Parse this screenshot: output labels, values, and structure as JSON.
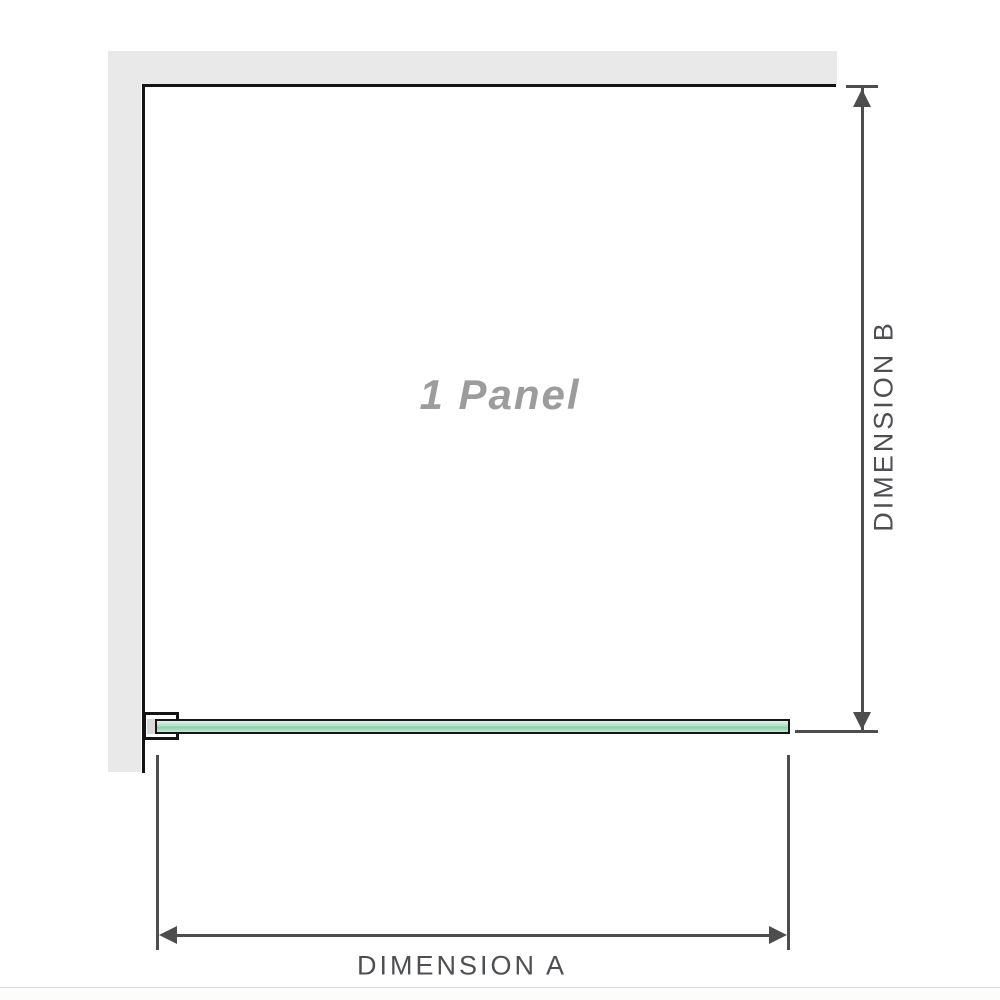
{
  "diagram": {
    "panel_label": "1 Panel",
    "dimension_a_label": "DIMENSION A",
    "dimension_b_label": "DIMENSION B"
  },
  "colors": {
    "wall_gray": "#e9e9e9",
    "structure_black": "#141414",
    "dimension_line_gray": "#4d4d4d",
    "dimension_text_gray": "#4d4f52",
    "panel_label_gray": "#9c9c9c",
    "glass_green_light": "#dff3e8",
    "glass_green": "#b3e1c7",
    "glass_green_dark": "#8fcfae",
    "bracket_pad_gray": "#d9d9d9",
    "footer_rule_gray": "#dcdcda"
  }
}
